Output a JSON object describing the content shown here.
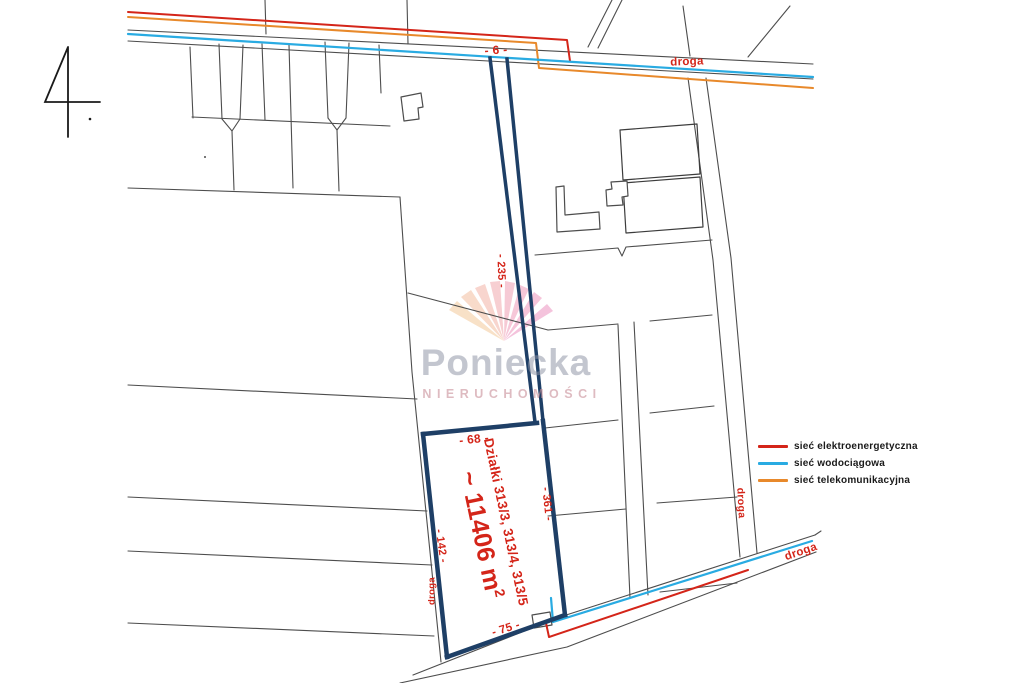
{
  "page": {
    "sheet_number": "4"
  },
  "watermark": {
    "brand": "Poniecka",
    "subtitle": "NIERUCHOMOŚCI"
  },
  "legend": {
    "items": [
      {
        "label": "sieć elektroenergetyczna",
        "color": "#d42519"
      },
      {
        "label": "sieć wodociągowa",
        "color": "#29abe2"
      },
      {
        "label": "sieć telekomunikacyjna",
        "color": "#e8892b"
      }
    ]
  },
  "parcel": {
    "plots_label": "Działki 313/3, 313/4, 313/5",
    "area_value": "~ 11406 m",
    "area_exponent": "2"
  },
  "dimensions": {
    "top": "- 6 -",
    "strip": "- 235 -",
    "upper_width": "- 68 -",
    "right": "- 361 -",
    "left": "- 142 -",
    "bottom": "- 75 -"
  },
  "roads": {
    "top": "droga",
    "access_strip": "droga",
    "right": "droga",
    "bottom": "droga"
  },
  "colors": {
    "boundary": "#1e3f66",
    "parcel_lines": "#4d4d4d",
    "dimension_text": "#d42519",
    "power_line": "#d42519",
    "water_line": "#29abe2",
    "telecom_line": "#e8892b"
  }
}
